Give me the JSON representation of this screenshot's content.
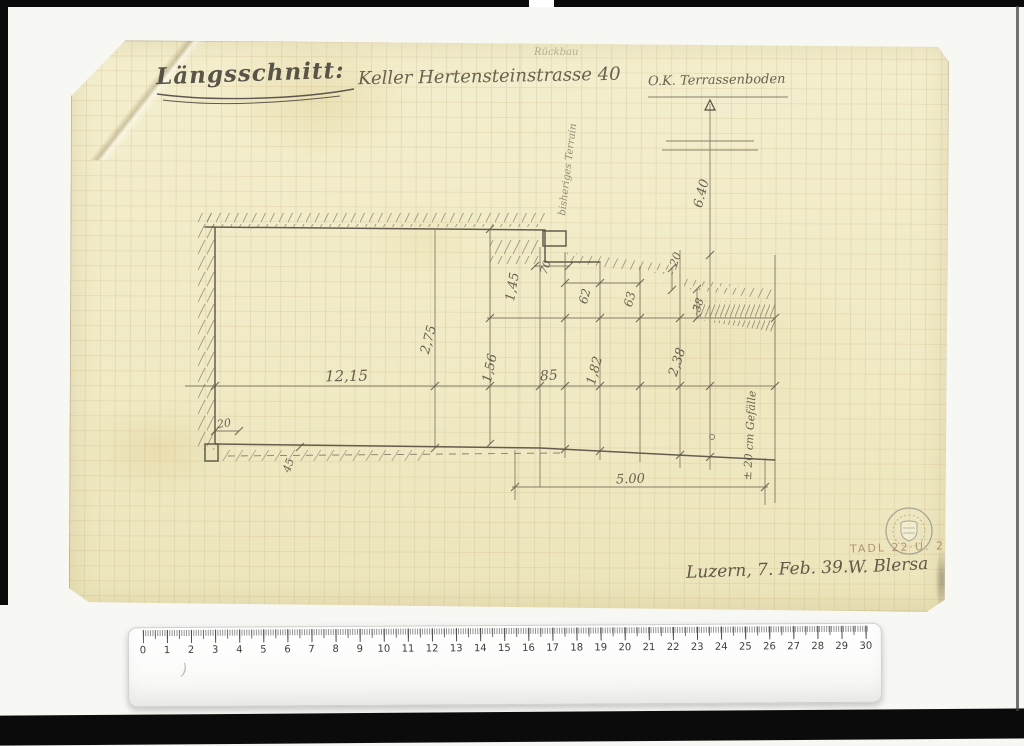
{
  "drawing": {
    "title": "Längsschnitt:",
    "subtitle": "Keller Hertensteinstrasse 40",
    "datum_label": "O.K. Terrassenboden",
    "faint_note": "Rückbau",
    "terrain_label": "bisheriges Terrain",
    "place_date": "Luzern, 7. Feb. 39.",
    "signature": "W. Blersa",
    "archive_code": "TADL 22 U. 2"
  },
  "dimensions": {
    "room_width": "12,15",
    "room_height": "2,75",
    "wall_145": "1,45",
    "wall_156": "1,56",
    "seg_85": "85",
    "seg_182": "1,82",
    "seg_238": "2,38",
    "height_640": "6.40",
    "step_70": "70",
    "step_62": "62",
    "step_63": "63",
    "step_20": "20",
    "step_38": "38",
    "base_20": "20",
    "base_45": "45",
    "span_500": "5.00",
    "slope_note": "± 20 cm Gefälle"
  },
  "ruler": {
    "labels": [
      "0",
      "1",
      "2",
      "3",
      "4",
      "5",
      "6",
      "7",
      "8",
      "9",
      "10",
      "11",
      "12",
      "13",
      "14",
      "15",
      "16",
      "17",
      "18",
      "19",
      "20",
      "21",
      "22",
      "23",
      "24",
      "25",
      "26",
      "27",
      "28",
      "29",
      "30"
    ],
    "mark": ")"
  }
}
